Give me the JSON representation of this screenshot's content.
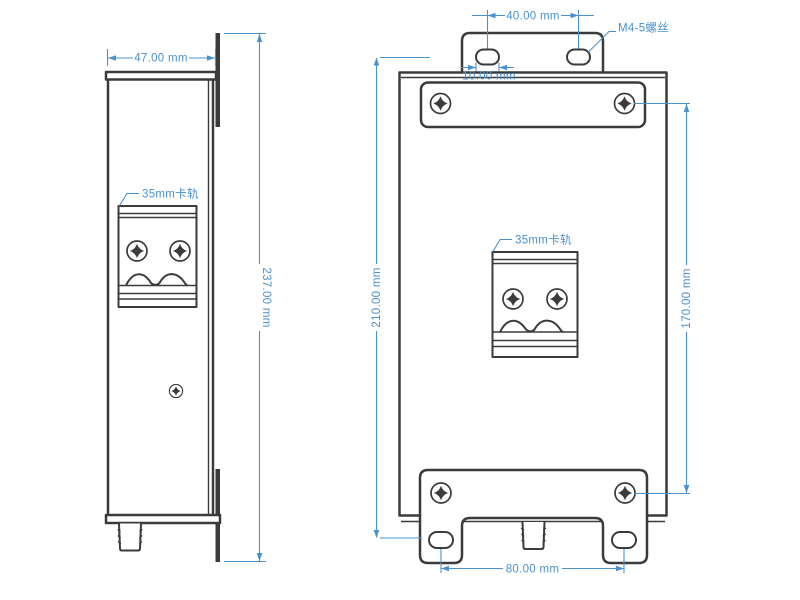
{
  "colors": {
    "line": "#3b3b3b",
    "dim": "#4a91cd",
    "bg": "#ffffff"
  },
  "side_view": {
    "width_dim": "47.00 mm",
    "height_dim": "237.00 mm",
    "din_rail_label": "35mm卡轨"
  },
  "front_view": {
    "top_slot_spacing_dim": "40.00 mm",
    "slot_width_dim": "10.00 mm",
    "screw_label": "M4-5螺丝",
    "left_height_dim": "210.00 mm",
    "right_height_dim": "170.00 mm",
    "din_rail_label": "35mm卡轨",
    "bottom_slot_spacing_dim": "80.00 mm"
  }
}
